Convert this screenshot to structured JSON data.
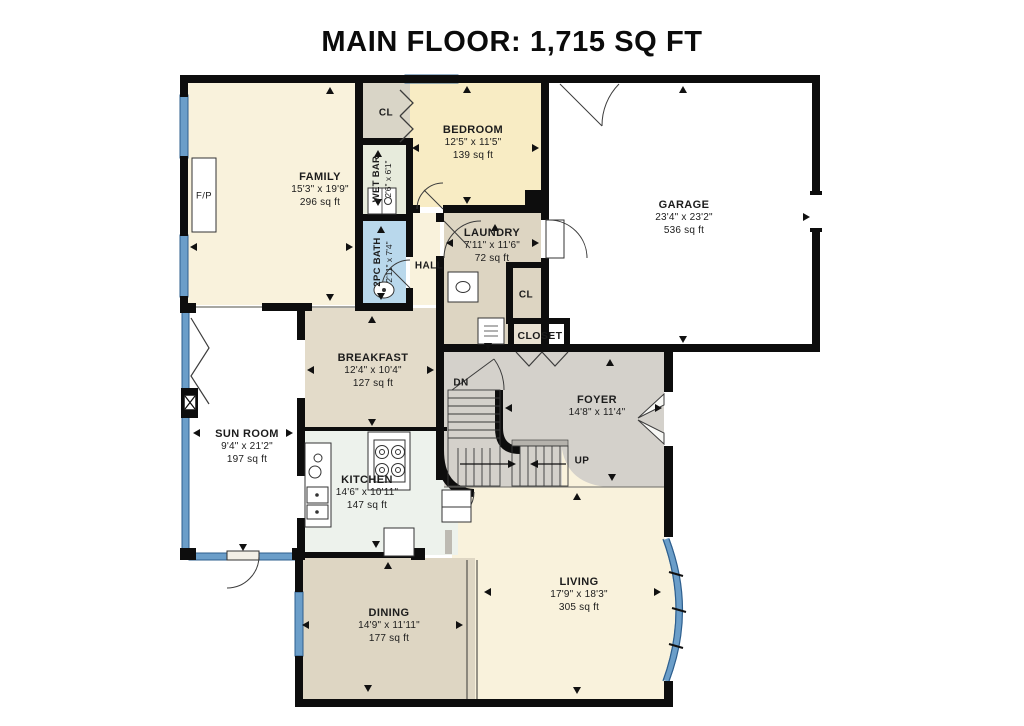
{
  "title": "MAIN FLOOR: 1,715 SQ FT",
  "rooms": {
    "family": {
      "name": "FAMILY",
      "dims": "15'3\" x 19'9\"",
      "area": "296 sq ft"
    },
    "bedroom": {
      "name": "BEDROOM",
      "dims": "12'5\" x 11'5\"",
      "area": "139 sq ft"
    },
    "garage": {
      "name": "GARAGE",
      "dims": "23'4\" x 23'2\"",
      "area": "536 sq ft"
    },
    "laundry": {
      "name": "LAUNDRY",
      "dims": "7'11\" x 11'6\"",
      "area": "72 sq ft"
    },
    "wet_bar": {
      "name": "WET BAR",
      "dims": "2'6\" x 6'1\""
    },
    "bath": {
      "name": "2PC BATH",
      "dims": "2'11\" x 7'4\""
    },
    "hall": {
      "name": "HALL"
    },
    "closet_top": {
      "name": "CL"
    },
    "closet_laundry": {
      "name": "CL"
    },
    "closet_foyer": {
      "name": "CLOSET"
    },
    "breakfast": {
      "name": "BREAKFAST",
      "dims": "12'4\" x 10'4\"",
      "area": "127 sq ft"
    },
    "sun_room": {
      "name": "SUN ROOM",
      "dims": "9'4\" x 21'2\"",
      "area": "197 sq ft"
    },
    "kitchen": {
      "name": "KITCHEN",
      "dims": "14'6\" x 10'11\"",
      "area": "147 sq ft"
    },
    "foyer": {
      "name": "FOYER",
      "dims": "14'8\" x 11'4\""
    },
    "dining": {
      "name": "DINING",
      "dims": "14'9\" x 11'11\"",
      "area": "177 sq ft"
    },
    "living": {
      "name": "LIVING",
      "dims": "17'9\" x 18'3\"",
      "area": "305 sq ft"
    }
  },
  "annotations": {
    "fireplace": "F/P",
    "stairs_down": "DN",
    "stairs_up": "UP"
  },
  "colors": {
    "wall": "#0d0d0d",
    "window_blue": "#6b9ec9",
    "window_edge": "#2e5f8e",
    "cream": "#f9f2dc",
    "bedroom_yellow": "#f8ecc4",
    "laundry_tan": "#ddd5c2",
    "breakfast_tan": "#e3dbc9",
    "dining_tan": "#ded6c3",
    "closet_gray": "#d9d5c7",
    "foyer_gray": "#d4d1cb",
    "bath_blue": "#b9d8ec",
    "wetbar_green": "#e7ebdc",
    "kitchen_green": "#edf2ec",
    "white": "#ffffff"
  }
}
